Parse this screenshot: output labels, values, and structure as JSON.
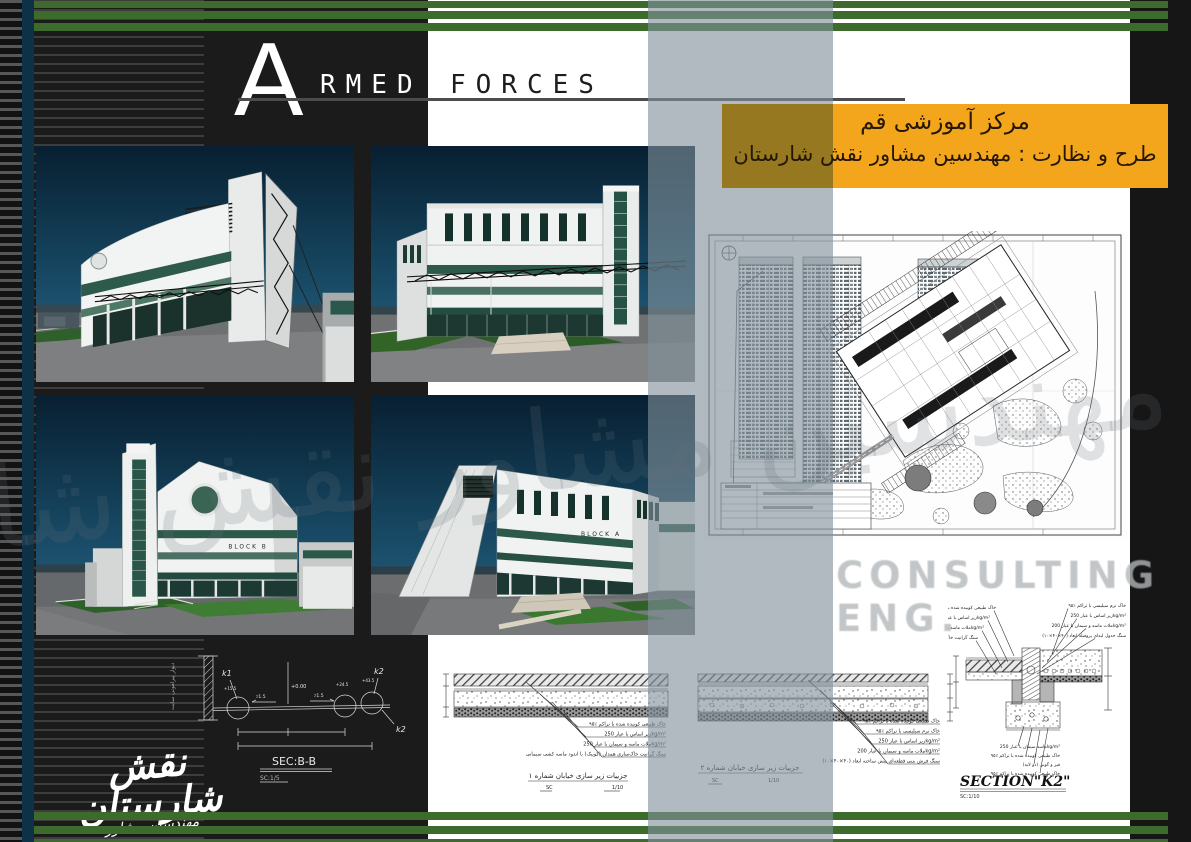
{
  "header": {
    "big_letter": "A",
    "word_rest": "RMED",
    "word_second": "FORCES"
  },
  "title_box": {
    "line1": "مرکز آموزشی قم",
    "line2": "طرح و نظارت : مهندسین مشاور نقش شارستان",
    "bg_color": "#f3a61c"
  },
  "watermarks": {
    "persian_script": "مهندسین مشاور نقش شارستان",
    "latin": "CONSULTING ENG."
  },
  "logo": {
    "main": "نقش شارستان",
    "script": "مهندسین مشاور"
  },
  "renders": {
    "block_a_label": "BLOCK A",
    "block_b_label": "BLOCK B"
  },
  "sec_bb": {
    "title": "SEC:B-B",
    "scale": "SC:1/5",
    "k1": "k1",
    "k2": "k2",
    "wall_label": "دیوار پیرامونی سایت",
    "elevation": "+0.00",
    "slope_left": "٪1.5",
    "slope_right": "٪1.5",
    "elev_marks": [
      "+15.5",
      "+24.5",
      "+43.5"
    ]
  },
  "street_detail_1": {
    "title": "جزییات زیر سازی خیابان شماره ۱",
    "scale_label": "SC",
    "scale_value": "1/10",
    "annotations": [
      "خاک طبیعی کوبیده شده با تراکم ٪۹۵",
      "زیر اساس با عیار 250kg/m²",
      "ملات ماسه و سیمان با عیار 250kg/m²",
      "سنگ گرانیت خاک‌ساری همدان (کوبیک) با اندود ماسه کشی سیمانی"
    ]
  },
  "street_detail_2": {
    "title": "جزییات زیر سازی خیابان شماره ۲",
    "scale_label": "SC",
    "scale_value": "1/10",
    "annotations": [
      "خاک طبیعی کوبیده شده با تراکم ٪۹۵",
      "خاک نرم سیلیسی با تراکم ٪۹۵",
      "زیر اساس با عیار 250kg/m²",
      "ملات ماسه و سیمان با عیار 200kg/m²",
      "سنگ فرش بتنی قطعه‌ای پیش ساخته ابعاد (۴۰×۴۰×۱۰)"
    ]
  },
  "section_k2": {
    "title": "SECTION\"K2\"",
    "scale": "SC:1/10",
    "annotations_left": [
      "خاک طبیعی کوبیده شده با تراکم ٪۹۵",
      "زیر اساس با عیار 250kg/m²",
      "ملات ماسه و سیمان با عیار 250kg/m²",
      "سنگ گرانیت خاک‌ساری"
    ],
    "annotations_right": [
      "خاک نرم سیلیسی با تراکم ٪۹۵",
      "زیر اساس با عیار 250kg/m²",
      "ملات ماسه و سیمان با عیار 200kg/m²",
      "سنگ جدول لبه‌ای پروفیله ابعاد (۴۰×۴۰×۱۰)"
    ],
    "annotations_bottom": [
      "ماسه سیمان با عیار 250kg/m²",
      "خاک طبیعی کوبیده شده با تراکم ٪۹۵",
      "قیر و گونی (دو لایه)",
      "خاک طبیعی کوبیده شده با تراکم ٪۹۵"
    ]
  }
}
